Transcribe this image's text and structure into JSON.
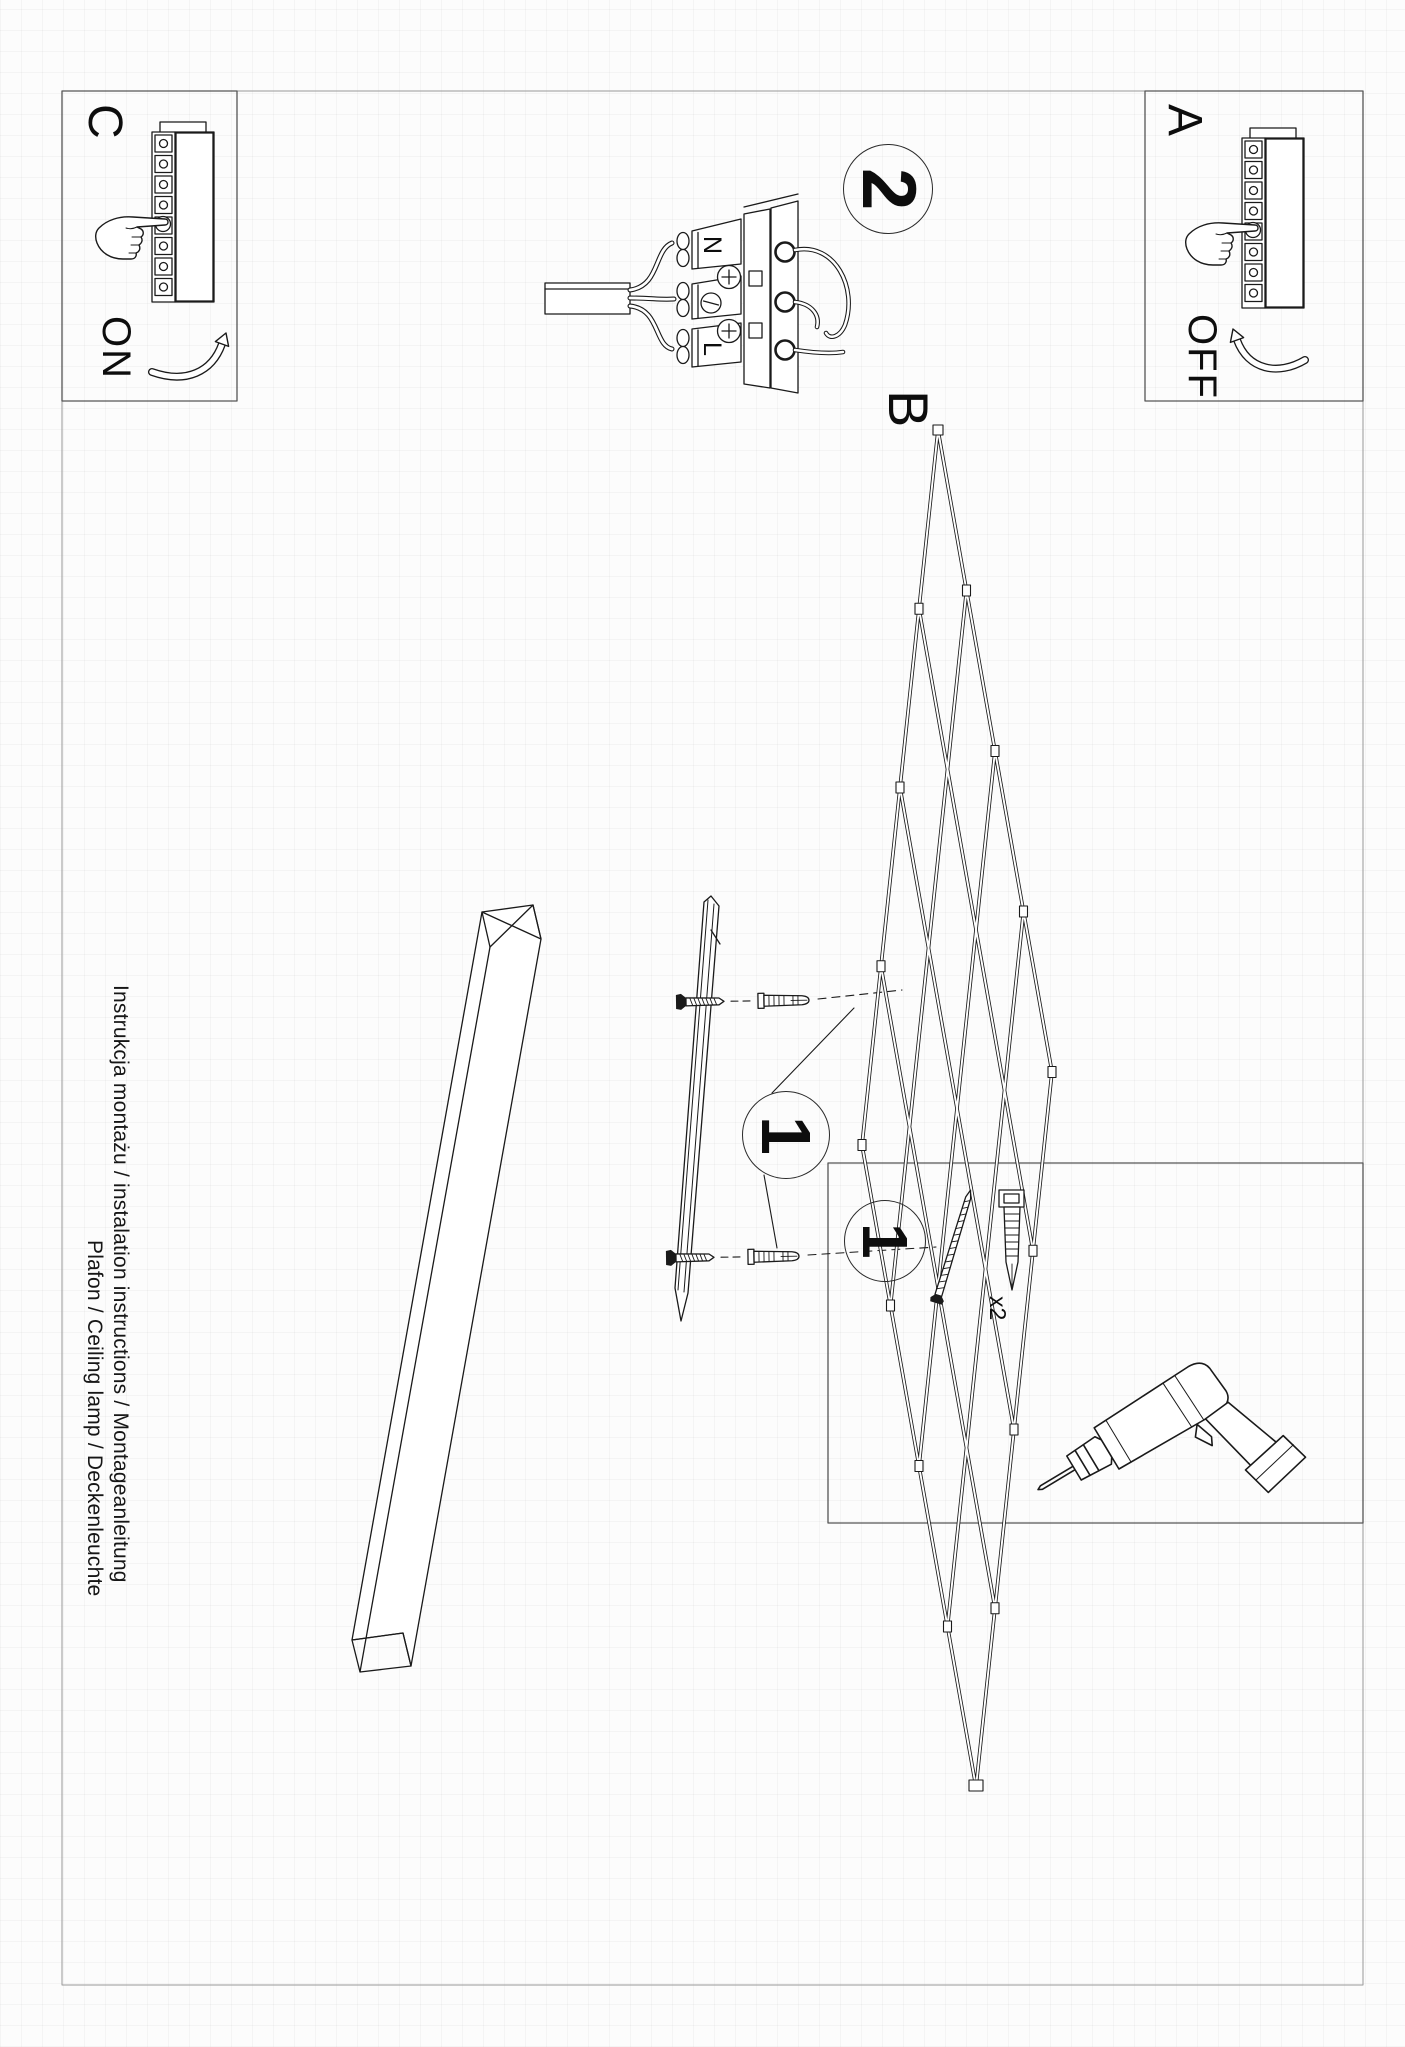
{
  "page": {
    "background": "#fcfcfc",
    "line_color": "#1a1a1a",
    "frame_color": "#8f8f8f"
  },
  "sections": {
    "a": {
      "label": "A",
      "action": "OFF"
    },
    "b": {
      "label": "B"
    },
    "c": {
      "label": "C",
      "action": "ON"
    },
    "step_wiring": {
      "number": "2"
    },
    "step_mounting": {
      "number": "1"
    },
    "step_tools": {
      "number": "1",
      "quantity": "x2"
    }
  },
  "wiring": {
    "terminal_n": "N",
    "terminal_l": "L"
  },
  "footer": {
    "line1": "Instrukcja montażu / instalation instructions / Montageanleitung",
    "line2": "Plafon / Ceiling lamp / Deckenleuchte"
  }
}
